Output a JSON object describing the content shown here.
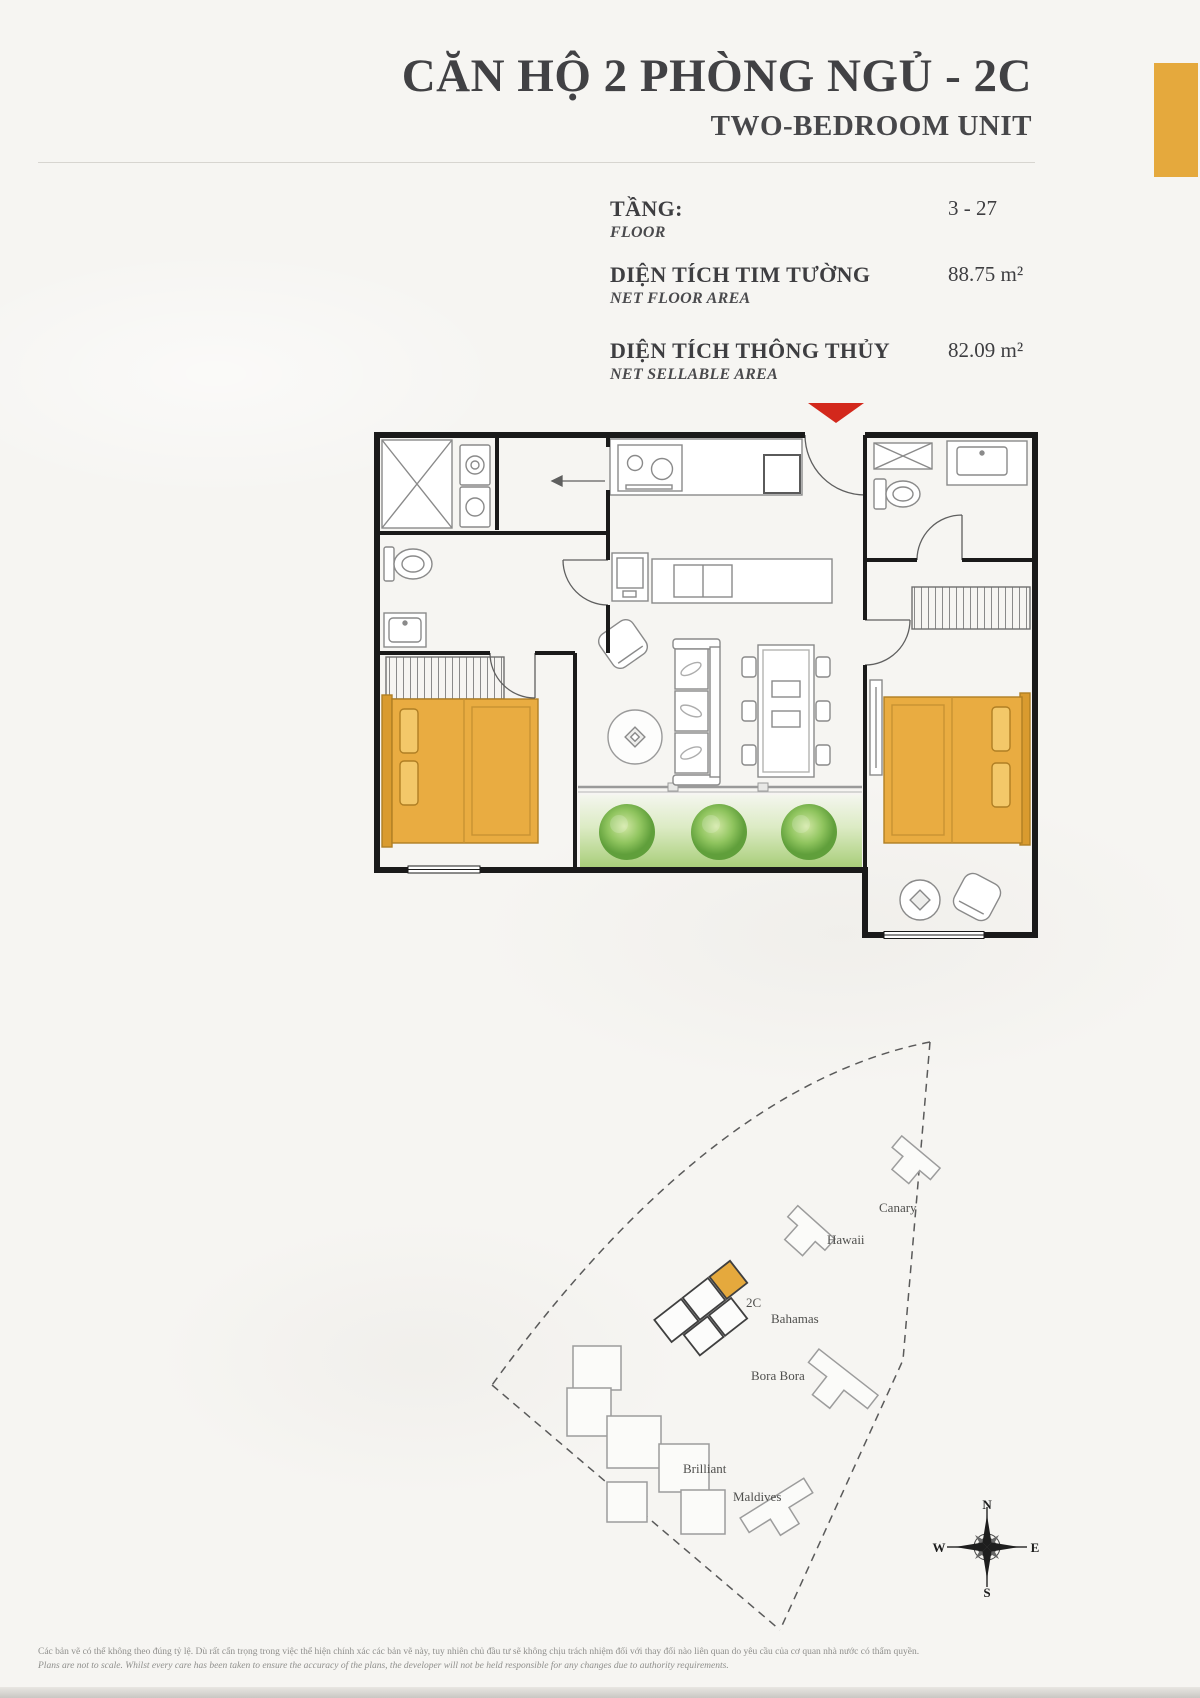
{
  "header": {
    "title_vi": "CĂN HỘ 2 PHÒNG NGỦ - 2C",
    "title_en": "TWO-BEDROOM UNIT",
    "accent_color": "#E5A93D"
  },
  "specs": [
    {
      "label_vi": "TẦNG:",
      "label_en": "FLOOR",
      "value": "3 - 27"
    },
    {
      "label_vi": "DIỆN TÍCH TIM TƯỜNG",
      "label_en": "NET FLOOR AREA",
      "value": "88.75 m²"
    },
    {
      "label_vi": "DIỆN TÍCH THÔNG THỦY",
      "label_en": "NET SELLABLE AREA",
      "value": "82.09 m²"
    }
  ],
  "floor_plan": {
    "entrance_marker_color": "#D3281C",
    "bed_color": "#E9AC41",
    "wall_color": "#1a1a1a"
  },
  "site_map": {
    "unit_label": "2C",
    "buildings": [
      {
        "id": "canary",
        "label": "Canary"
      },
      {
        "id": "hawaii",
        "label": "Hawaii"
      },
      {
        "id": "bahamas",
        "label": "Bahamas"
      },
      {
        "id": "bora-bora",
        "label": "Bora Bora"
      },
      {
        "id": "brilliant",
        "label": "Brilliant"
      },
      {
        "id": "maldives",
        "label": "Maldives"
      }
    ],
    "compass": {
      "n": "N",
      "s": "S",
      "e": "E",
      "w": "W"
    }
  },
  "footer": {
    "line_vi": "Các bản vẽ có thể không theo đúng tỷ lệ. Dù rất cẩn trọng trong việc thể hiện chính xác các bản vẽ này, tuy nhiên chủ đầu tư sẽ không chịu trách nhiệm đối với thay đổi nào liên quan do yêu cầu của cơ quan nhà nước có thẩm quyền.",
    "line_en": "Plans are not to scale. Whilst every care has been taken to ensure the accuracy of the plans, the developer will not be held responsible for any changes due to authority requirements."
  }
}
